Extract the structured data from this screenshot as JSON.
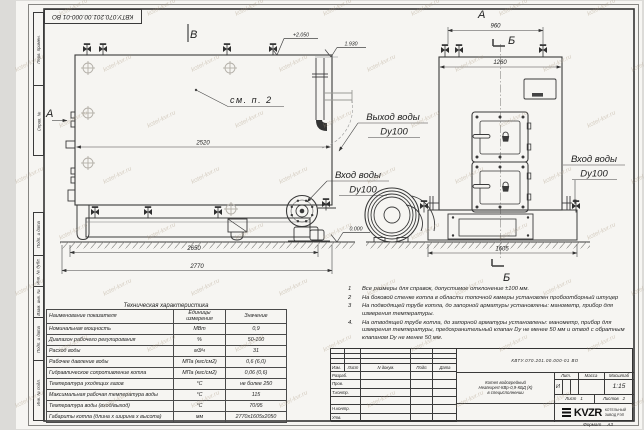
{
  "watermark": "kotel-kvr.ru",
  "stamp_top": "КВТУ.070.201.00.000-01 ВО",
  "margin_labels": [
    "Перв. примен.",
    "Справ. №",
    "Подп. и дата",
    "Инв. № дубл.",
    "Взам. инв. №",
    "Подп. и дата",
    "Инв. № подл."
  ],
  "views": {
    "side": {
      "marker_top": "В",
      "marker_left": "А",
      "note_ref": "см. п. 2",
      "elev_top": "+2.050",
      "elev_pipe": "1.930",
      "elev_ground": "0.000",
      "dim_inner": "2520",
      "dim_base": "2650",
      "dim_overall": "2770",
      "label_outlet": "Выход воды",
      "label_outlet_dn": "Dy100",
      "label_inlet": "Вход воды",
      "label_inlet_dn": "Dy100"
    },
    "front": {
      "marker_top": "А",
      "section": "Б",
      "dim_valves": "960",
      "dim_width": "1260",
      "dim_base": "1605",
      "label_inlet": "Вход воды",
      "label_inlet_dn": "Dy100"
    }
  },
  "tech_table": {
    "title": "Техническая характеристика",
    "headers": [
      "Наименование показателя",
      "Единицы измерения",
      "Значение"
    ],
    "rows": [
      [
        "Номинальная мощность",
        "МВт",
        "0,9"
      ],
      [
        "Диапазон рабочего регулирования",
        "%",
        "50-100"
      ],
      [
        "Расход воды",
        "м3/ч",
        "31"
      ],
      [
        "Рабочее давление воды",
        "МПа (кгс/см2)",
        "0,6 (6,0)"
      ],
      [
        "Гидравлическое сопротивление котла",
        "МПа (кгс/см2)",
        "0,06 (0,6)"
      ],
      [
        "Температура уходящих газов",
        "°С",
        "не более 250"
      ],
      [
        "Максимальная рабочая температура воды",
        "°С",
        "115"
      ],
      [
        "Температура воды (вход/выход)",
        "°С",
        "70/95"
      ],
      [
        "Габариты котла (длина х ширина х высота)",
        "мм",
        "2770х1605х2050"
      ]
    ]
  },
  "notes": [
    {
      "num": "1",
      "text": "Все размеры для справок, допустимое отклонение ±100 мм."
    },
    {
      "num": "2",
      "text": "На боковой стенке котла в области топочной камеры установлен пробоотборный штуцер"
    },
    {
      "num": "3",
      "text": "На подводящей трубе котла, до запорной арматуры установлены: манометр, прибор для измерения температуры."
    },
    {
      "num": "4.",
      "text": "На отводящей трубе котла, до запорной арматуры установлены: манометр, прибор для измерения температуры, предохранительный клапан Dy не менее 50 мм и отвод с обратным клапаном Dy не менее 50 мм."
    }
  ],
  "title_block": {
    "doc_number": "КВТУ.070.201.00.000-01 ВО",
    "name_lines": [
      "Котел водогрейный",
      "Heatexpert-КВр-0,9-КБД (К)",
      "в специсполнении"
    ],
    "sig_headers": [
      "Изм.",
      "Лист",
      "N докум.",
      "Подп.",
      "Дата"
    ],
    "sig_rows": [
      "Разраб.",
      "Пров.",
      "Т.контр.",
      "",
      "Н.контр.",
      "Утв."
    ],
    "lit_label": "Лит.",
    "mass_label": "Масса",
    "scale_label": "Масштаб",
    "lit_value": "И",
    "scale_value": "1:15",
    "sheet_label": "Лист",
    "sheet_value": "1",
    "sheets_label": "Листов",
    "sheets_value": "2",
    "company_logo": "KVZR",
    "company_name1": "КОТЕЛЬНЫЙ",
    "company_name2": "ЗАВОД РЭП",
    "format_label": "Формат",
    "format_value": "А3"
  }
}
